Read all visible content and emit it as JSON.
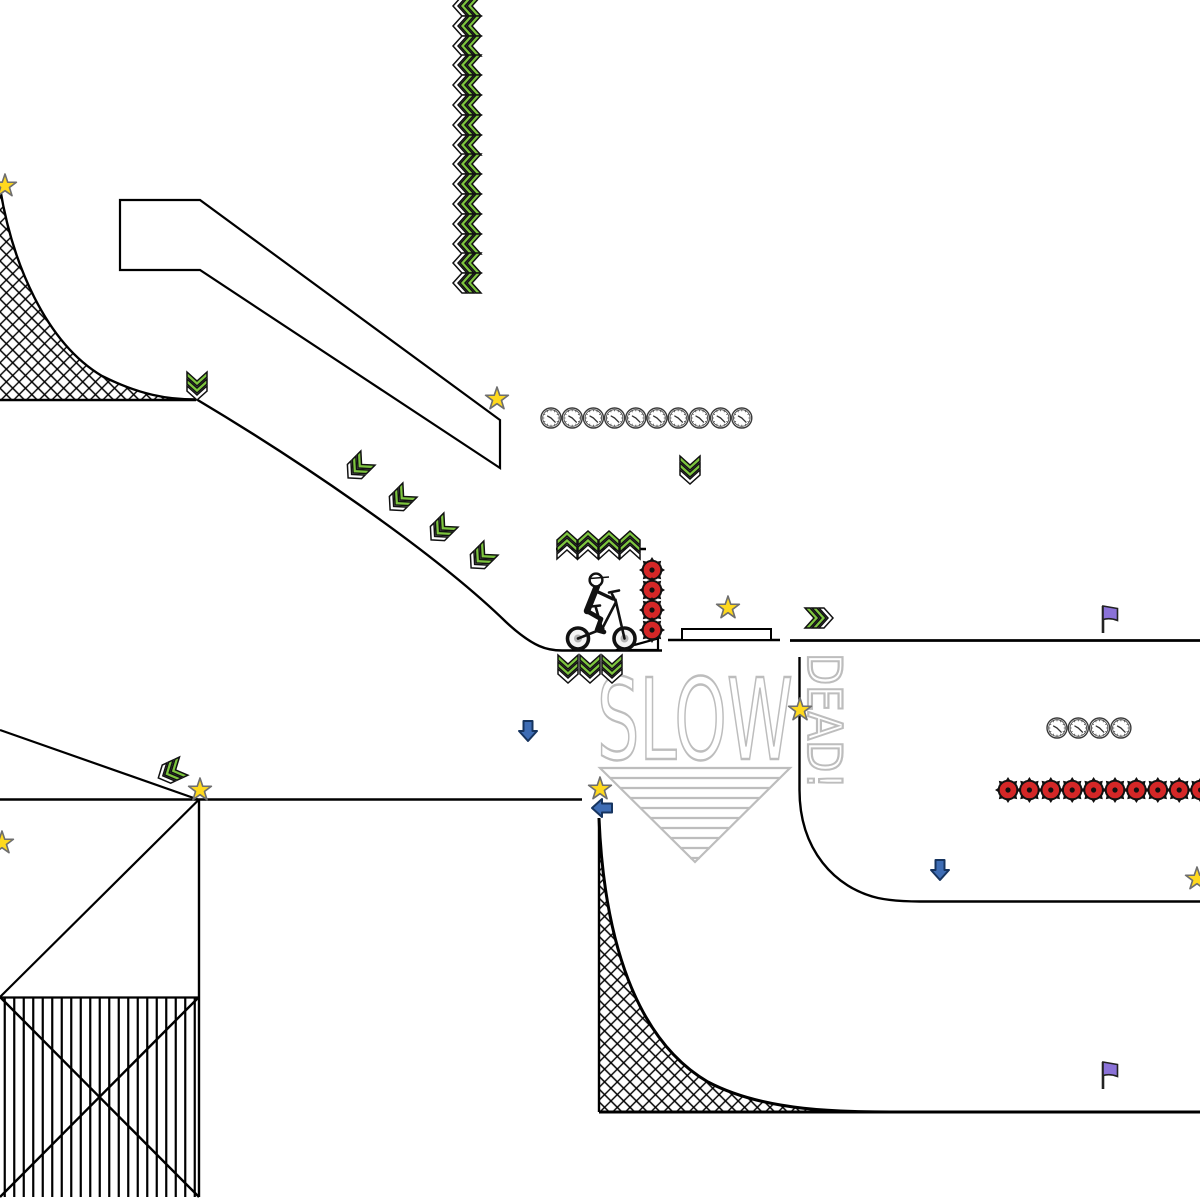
{
  "scene": {
    "name": "bike-stunt-track-level",
    "background": "#ffffff"
  },
  "watermark": {
    "slow": "SLOW",
    "dead": "DEAD!"
  },
  "colors": {
    "ink": "#000000",
    "green": "#7dc53e",
    "red": "#d42727",
    "blue": "#3e6db5",
    "purple": "#8b72d8",
    "yellow": "#ffd91e",
    "gray": "#bdbdbd"
  },
  "items": {
    "stars": [
      [
        5,
        186
      ],
      [
        497,
        399
      ],
      [
        728,
        608
      ],
      [
        800,
        710
      ],
      [
        600,
        789
      ],
      [
        200,
        790
      ],
      [
        2,
        843
      ],
      [
        1197,
        879
      ]
    ],
    "boosts": [
      [
        467,
        6,
        -90
      ],
      [
        467,
        26,
        -90
      ],
      [
        467,
        46,
        -90
      ],
      [
        467,
        65,
        -90
      ],
      [
        467,
        85,
        -90
      ],
      [
        467,
        105,
        -90
      ],
      [
        467,
        125,
        -90
      ],
      [
        467,
        145,
        -90
      ],
      [
        467,
        164,
        -90
      ],
      [
        467,
        184,
        -90
      ],
      [
        467,
        204,
        -90
      ],
      [
        467,
        224,
        -90
      ],
      [
        467,
        244,
        -90
      ],
      [
        467,
        263,
        -90
      ],
      [
        467,
        283,
        -90
      ],
      [
        197,
        386,
        180
      ],
      [
        358,
        468,
        225
      ],
      [
        400,
        500,
        225
      ],
      [
        441,
        530,
        225
      ],
      [
        481,
        558,
        225
      ],
      [
        690,
        470,
        180
      ],
      [
        567,
        545,
        0,
        "b"
      ],
      [
        588,
        545,
        0,
        "b"
      ],
      [
        609,
        545,
        0,
        "b"
      ],
      [
        630,
        545,
        0,
        "b"
      ],
      [
        568,
        669,
        180
      ],
      [
        590,
        669,
        180
      ],
      [
        612,
        669,
        180
      ],
      [
        819,
        618,
        90
      ],
      [
        171,
        772,
        -115
      ]
    ],
    "clock_rows": [
      {
        "x": 551,
        "y": 418,
        "count": 10,
        "dx": 21.2
      },
      {
        "x": 1057,
        "y": 728,
        "count": 4,
        "dx": 21.3
      }
    ],
    "spike_rows": [
      {
        "x": 652,
        "y": 570,
        "count": 4,
        "dx": 0,
        "dy": 20
      },
      {
        "x": 1008,
        "y": 790,
        "count": 10,
        "dx": 21.4,
        "dy": 0
      }
    ],
    "flags": [
      [
        1103,
        633
      ],
      [
        1103,
        1089
      ]
    ],
    "blue_arrows": [
      [
        528,
        731,
        0
      ],
      [
        940,
        870,
        0
      ],
      [
        602,
        808,
        90
      ]
    ]
  }
}
